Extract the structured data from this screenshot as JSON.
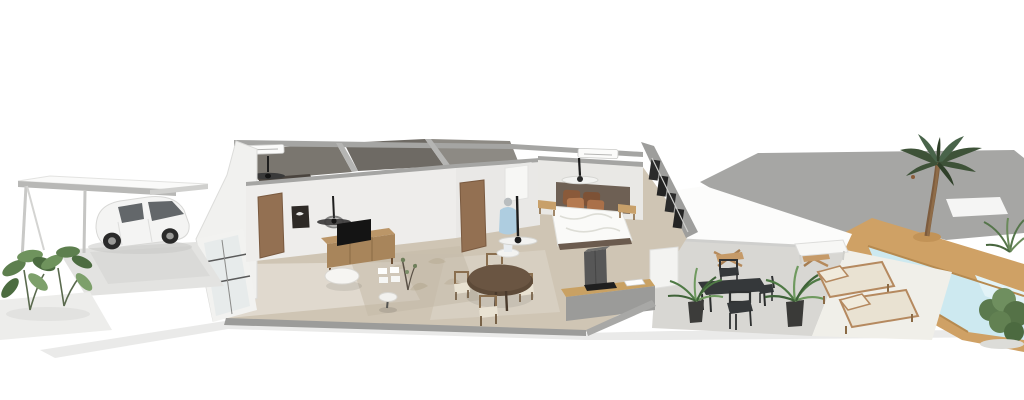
{
  "scene": {
    "title": "3D isometric cutaway floor plan render of a single-storey house",
    "view": "elevated front-left perspective, white background, no visible text"
  },
  "colors": {
    "floor-tan": "#cfc5b4",
    "backroom-floor": "#7a766f",
    "wall-cap": "#a5a5a3",
    "wall-white": "#f1f1ef",
    "backyard-gray": "#a6a6a4",
    "pool-water": "#cde9f0",
    "pool-deck": "#cfa165",
    "canopy-white": "#fcfcfb",
    "patio-concrete": "#d8d7d3",
    "sand-white": "#f0efe9",
    "wood-furniture": "#bb9668",
    "wood-dark": "#5d4a38",
    "patio-metal": "#35383a",
    "plant-green": "#5d7f4e",
    "palm-green": "#3e5238",
    "pillow-rust-dark": "#8a5a3a",
    "pillow-rust": "#b57a50",
    "headboard-brown": "#6e6054",
    "car-white": "#f4f4f3",
    "car-glass": "#63676a",
    "duvet-white": "#fafaf8",
    "cushion-beige": "#e9e2d2",
    "door-wood": "#937052",
    "soft-shadow": "#e3e3e1"
  },
  "objects": [
    {
      "name": "carport",
      "desc": "flat white roof on slim posts, left side"
    },
    {
      "name": "car",
      "desc": "white hatchback with dark windows parked under carport"
    },
    {
      "name": "shrubs",
      "desc": "two leafy green plants at lower left"
    },
    {
      "name": "living-room",
      "desc": "TV on wooden sideboard, round white coffee table, wall art, dark ceiling fan, wooden door"
    },
    {
      "name": "dining-area",
      "desc": "round dark wood table with four wooden chairs"
    },
    {
      "name": "mannequin",
      "desc": "figure in light blue shirt on round white pedestal"
    },
    {
      "name": "bedroom",
      "desc": "double bed with white duvet, rust pillows, dark headboard panel, two wooden benches, white ceiling fan, AC unit"
    },
    {
      "name": "kitchen",
      "desc": "gray island with wood counter, black cooktop, white sink, dark fridge column"
    },
    {
      "name": "patio",
      "desc": "covered terrace with dark metal dining set, wooden folding chairs, potted plants"
    },
    {
      "name": "sun-loungers",
      "desc": "two wood-frame loungers with beige cushions"
    },
    {
      "name": "pool",
      "desc": "light blue pool with tan wooden deck, lower right"
    },
    {
      "name": "palm-tree",
      "desc": "curved-trunk palm on the pool deck"
    },
    {
      "name": "backyard",
      "desc": "large flat gray yard plane behind pool"
    }
  ]
}
